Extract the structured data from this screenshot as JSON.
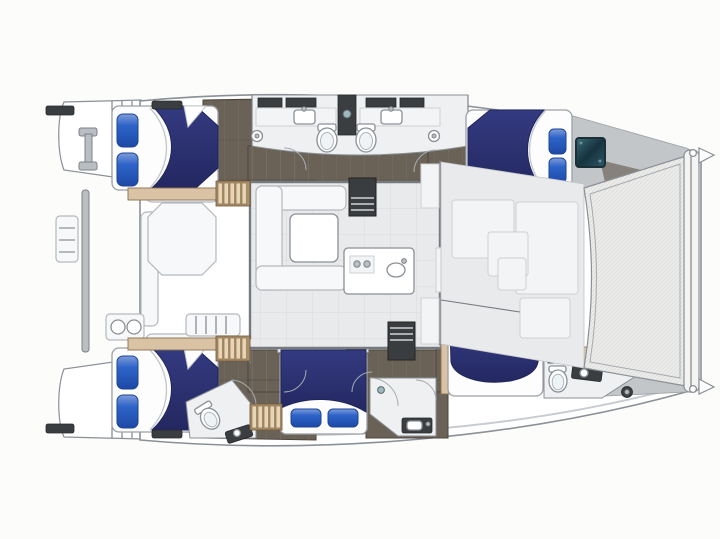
{
  "meta": {
    "title": "Catamaran yacht deck floor plan",
    "view": "top-down",
    "orientation": "bow facing right, stern facing left",
    "canvas": {
      "width": 720,
      "height": 539
    }
  },
  "colors": {
    "page_bg": "#fcfcfb",
    "hull": "#ffffff",
    "outline": "#8a9096",
    "deck_line": "#c8ccd0",
    "floor_dark": "#6b6257",
    "floor_dark_edge": "#4e463d",
    "floor_light": "#e9eaec",
    "bath_floor": "#eef0f1",
    "wood": "#d9c3a4",
    "wood_edge": "#8a6f4e",
    "duvet": "#2b2f6b",
    "duvet_dark": "#20255c",
    "pillow": "#2e64c9",
    "pillow_light": "#7f9cd8",
    "mattress": "#fdfdfd",
    "seat": "#f7f8f9",
    "seat_edge": "#b5b9bd",
    "counter_dark": "#3b3e41",
    "fixture": "#ffffff",
    "fixture_edge": "#8b9096",
    "window_teal": "#2e5866",
    "window_teal_dark": "#16333e",
    "gray_wedge": "#c3c6c9",
    "wall": "#757a7f",
    "mesh_bg": "#ececeb",
    "mesh_line": "#d8d8d6"
  },
  "rooms": {
    "salon": {
      "label": "Salon with U-shaped sofa and table"
    },
    "galley": {
      "label": "Galley island with sink and cooktop"
    },
    "aft_cockpit": {
      "label": "Aft cockpit with lounge table and seating"
    },
    "foredeck": {
      "label": "Forward deck lounge panels"
    },
    "trampoline": {
      "label": "Bow trampoline net"
    },
    "port_aft_cabin": {
      "label": "Port aft double cabin"
    },
    "port_forward_cabin": {
      "label": "Port forward double cabin"
    },
    "port_bathrooms": {
      "label": "Port back-to-back bathrooms with shower column"
    },
    "starboard_aft_cabin": {
      "label": "Starboard aft double cabin"
    },
    "starboard_mid_cabin": {
      "label": "Starboard mid double cabin"
    },
    "starboard_forward_cabin": {
      "label": "Starboard forward double cabin"
    },
    "starboard_aft_bathroom": {
      "label": "Starboard aft bathroom"
    },
    "starboard_mid_bathroom": {
      "label": "Starboard mid shower room"
    },
    "starboard_forward_bathroom": {
      "label": "Starboard forward bathroom with windlass"
    },
    "port_swim_platform": {
      "label": "Port swim platform with cleat"
    },
    "starboard_swim_platform": {
      "label": "Starboard swim platform"
    }
  },
  "beds": [
    {
      "location": "port aft",
      "pillows": 2,
      "pillow_side": "left"
    },
    {
      "location": "port forward",
      "pillows": 2,
      "pillow_side": "right"
    },
    {
      "location": "starboard aft",
      "pillows": 2,
      "pillow_side": "left"
    },
    {
      "location": "starboard mid",
      "pillows": 2,
      "pillow_side": "bottom"
    },
    {
      "location": "starboard forward",
      "pillows": 2,
      "pillow_side": "top"
    }
  ],
  "fixtures": {
    "double_berths": 5,
    "toilets": 4,
    "sinks": 6,
    "showers": 3,
    "staircases": 6,
    "deck_hatches": 4,
    "winches": 3,
    "cabin_window_hatch": 1
  }
}
